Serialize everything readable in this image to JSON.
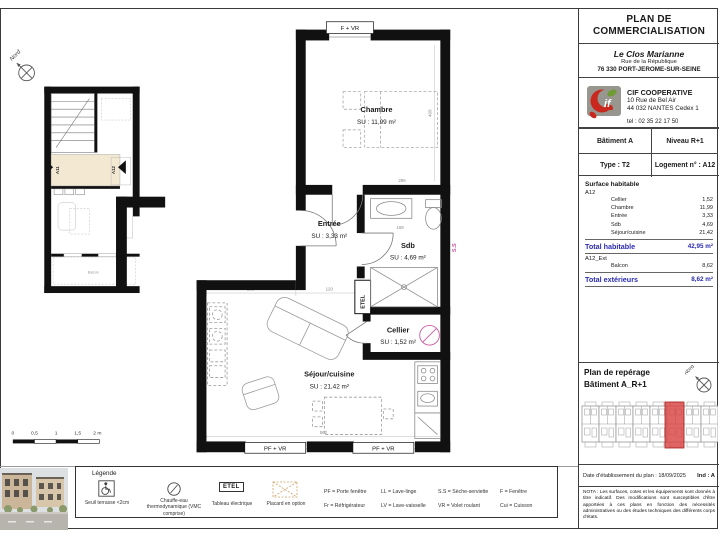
{
  "document": {
    "title_line1": "PLAN DE",
    "title_line2": "COMMERCIALISATION",
    "program": {
      "name": "Le Clos Marianne",
      "street": "Rue de la République",
      "city": "76 330 PORT-JEROME-SUR-SEINE"
    },
    "company": {
      "name": "CIF COOPERATIVE",
      "street": "10 Rue de Bel Air",
      "city": "44 032 NANTES Cedex 1",
      "tel": "tel : 02 35 22 17 50"
    },
    "date_line": "Date d'établissement du plan : 18/09/2025",
    "ind": "Ind : A",
    "nota": "NOTA : Les surfaces, cotes et les équipements sont donnés à titre indicatif. Des modifications sont susceptibles d'être apportées à ces plans en fonction des nécessités administratives ou des études techniques des différents corps d'états."
  },
  "unit": {
    "batiment": "Bâtiment A",
    "niveau": "Niveau R+1",
    "type": "Type : T2",
    "logement": "Logement n° : A12"
  },
  "surfaces": {
    "section_title": "Surface habitable",
    "group1": "A12",
    "rows": [
      {
        "name": "Cellier",
        "value": "1,52"
      },
      {
        "name": "Chambre",
        "value": "11,99"
      },
      {
        "name": "Entrée",
        "value": "3,33"
      },
      {
        "name": "Sdb",
        "value": "4,69"
      },
      {
        "name": "Séjour/cuisine",
        "value": "21,42"
      }
    ],
    "total_habitable_label": "Total habitable",
    "total_habitable_value": "42,95 m²",
    "group2": "A12_Ext",
    "ext_rows": [
      {
        "name": "Balcon",
        "value": "8,62"
      }
    ],
    "total_ext_label": "Total extérieurs",
    "total_ext_value": "8,62 m²"
  },
  "reperage": {
    "line1": "Plan de repérage",
    "line2": "Bâtiment A_R+1"
  },
  "plan": {
    "north": "Nord",
    "windows": {
      "top": "F + VR",
      "bottom": "PF + VR"
    },
    "rooms": {
      "chambre": {
        "name": "Chambre",
        "area": "SU : 11,99 m²"
      },
      "entree": {
        "name": "Entrée",
        "area": "SU : 3,33 m²"
      },
      "sdb": {
        "name": "Sdb",
        "area": "SU : 4,69 m²"
      },
      "cellier": {
        "name": "Cellier",
        "area": "SU : 1,52 m²"
      },
      "sejour": {
        "name": "Séjour/cuisine",
        "area": "SU : 21,42 m²"
      }
    },
    "etel": "ETEL",
    "ss": "S.S",
    "dims": [
      "296",
      "169",
      "120",
      "286",
      "562",
      "408"
    ],
    "scale": [
      "0",
      "0,5",
      "1",
      "1,5",
      "2 m"
    ],
    "overview": {
      "a11": "A11",
      "a12": "A12",
      "balcon": "Balcon"
    }
  },
  "legend": {
    "title": "Légende",
    "seuil": "Seuil terrasse <2cm",
    "chauffe": "Chauffe-eau thermodynamique (VMC comprise)",
    "etel_symbol": "ETEL",
    "etel_label": "Tableau électrique",
    "placard": "Placard en option",
    "abbr": [
      [
        "PF = Porte fenêtre",
        "LL = Lave-linge",
        "S.S = Sèche-serviette",
        "F = Fenêtre"
      ],
      [
        "Fr = Réfrigérateur",
        "LV = Lave-vaisselle",
        "VR = Volet roulant",
        "Cui = Cuisson"
      ]
    ]
  },
  "colors": {
    "total_blue": "#2b2bb0",
    "highlight_red": "#d84040",
    "landing_beige": "#f3e8d2",
    "symbol_pink": "#c9579f"
  }
}
